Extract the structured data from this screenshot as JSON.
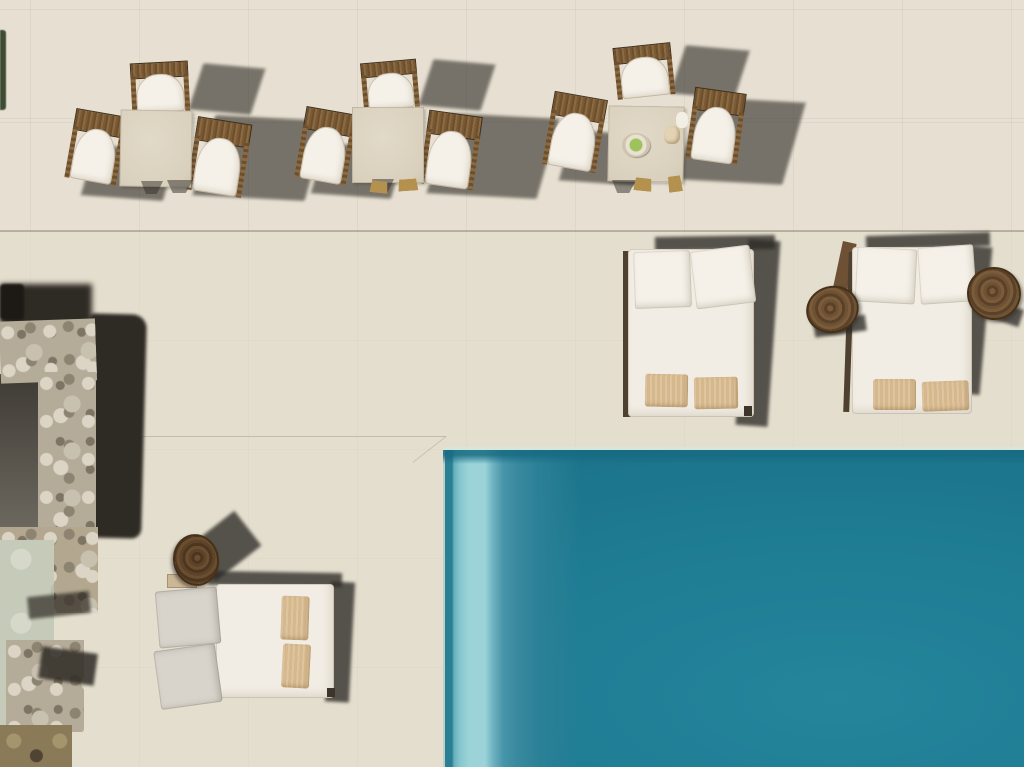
{
  "scene": {
    "description": "Aerial top-down drone photo of a beige stone villa terrace beside a turquoise swimming pool, hard sunlight casting long shadows to the right",
    "pool": {
      "position": "bottom-right quadrant",
      "left_edge_x": 443,
      "top_edge_y": 450,
      "features": [
        "pale coping lip line along top edge",
        "vertical lighter turquoise step bands along left edge",
        "deep teal open water"
      ]
    },
    "dining_sets": {
      "count": 3,
      "table": "square beige stone-top table",
      "chairs_per_set": 3,
      "chair_style": "brown wicker frame with woven back bar and white arched cushion",
      "set3_table_items": [
        "plate with green food",
        "small white dish/napkin"
      ]
    },
    "daybeds": {
      "count": 3,
      "style": "white double sun-daybed with two tilted backrest cushions and two tan pillows",
      "middle_daybed": "backrests facing up, dark shadow to the right",
      "right_daybed": "flanked by two round log side tables",
      "bottom_left_daybed": "rotated 90 degrees, backrests facing left, log side table at its head"
    },
    "log_side_tables": {
      "count": 3,
      "style": "round rustic tree-trunk stools with visible growth rings"
    },
    "stone_wall": "L-shaped rubble stone wall along left edge casting a near-black shadow, pale green flat rock and brown rocks below",
    "vegetation": "thin dark green shrub strip at extreme upper-left edge"
  },
  "colors": {
    "paving": "#e7e0d2",
    "paving_lower": "#e3dccc",
    "pool_deep": "#1e7b92",
    "pool_mid": "#24859b",
    "pool_dark_band": "#2a7f93",
    "step_light": "#9bd3d8",
    "step_mid": "#6fb3c1",
    "mint_edge": "#d6e6da",
    "shadow_soft": "rgba(50,46,41,0.62)",
    "shadow_bed": "rgba(45,42,38,0.78)",
    "wall_shadow": "#2e2a24",
    "stone_base": "#b5ab99",
    "stone_light": "#dcd5c6",
    "stone_dark": "#8d8371",
    "green_rock": "#c6cab8",
    "brown_rock": "#8a7a58",
    "inner_shade": "#4a463f",
    "white_cushion": "#f5f1e9",
    "mattress": "#f1ede4",
    "gray_cushion": "#d8d4cb",
    "tan_pillow": "#d7b88c",
    "wicker_dark": "#5d4326",
    "wicker_mid": "#8a6a41",
    "wood_log": "#6e5134",
    "wood_rail": "#4e412f",
    "table_top": "#d9d0bd",
    "table_top_hi": "#e2dac8",
    "veg_green": "#3e4c34",
    "plate_green": "#9fc25c",
    "gold_foot": "#b5914f"
  }
}
